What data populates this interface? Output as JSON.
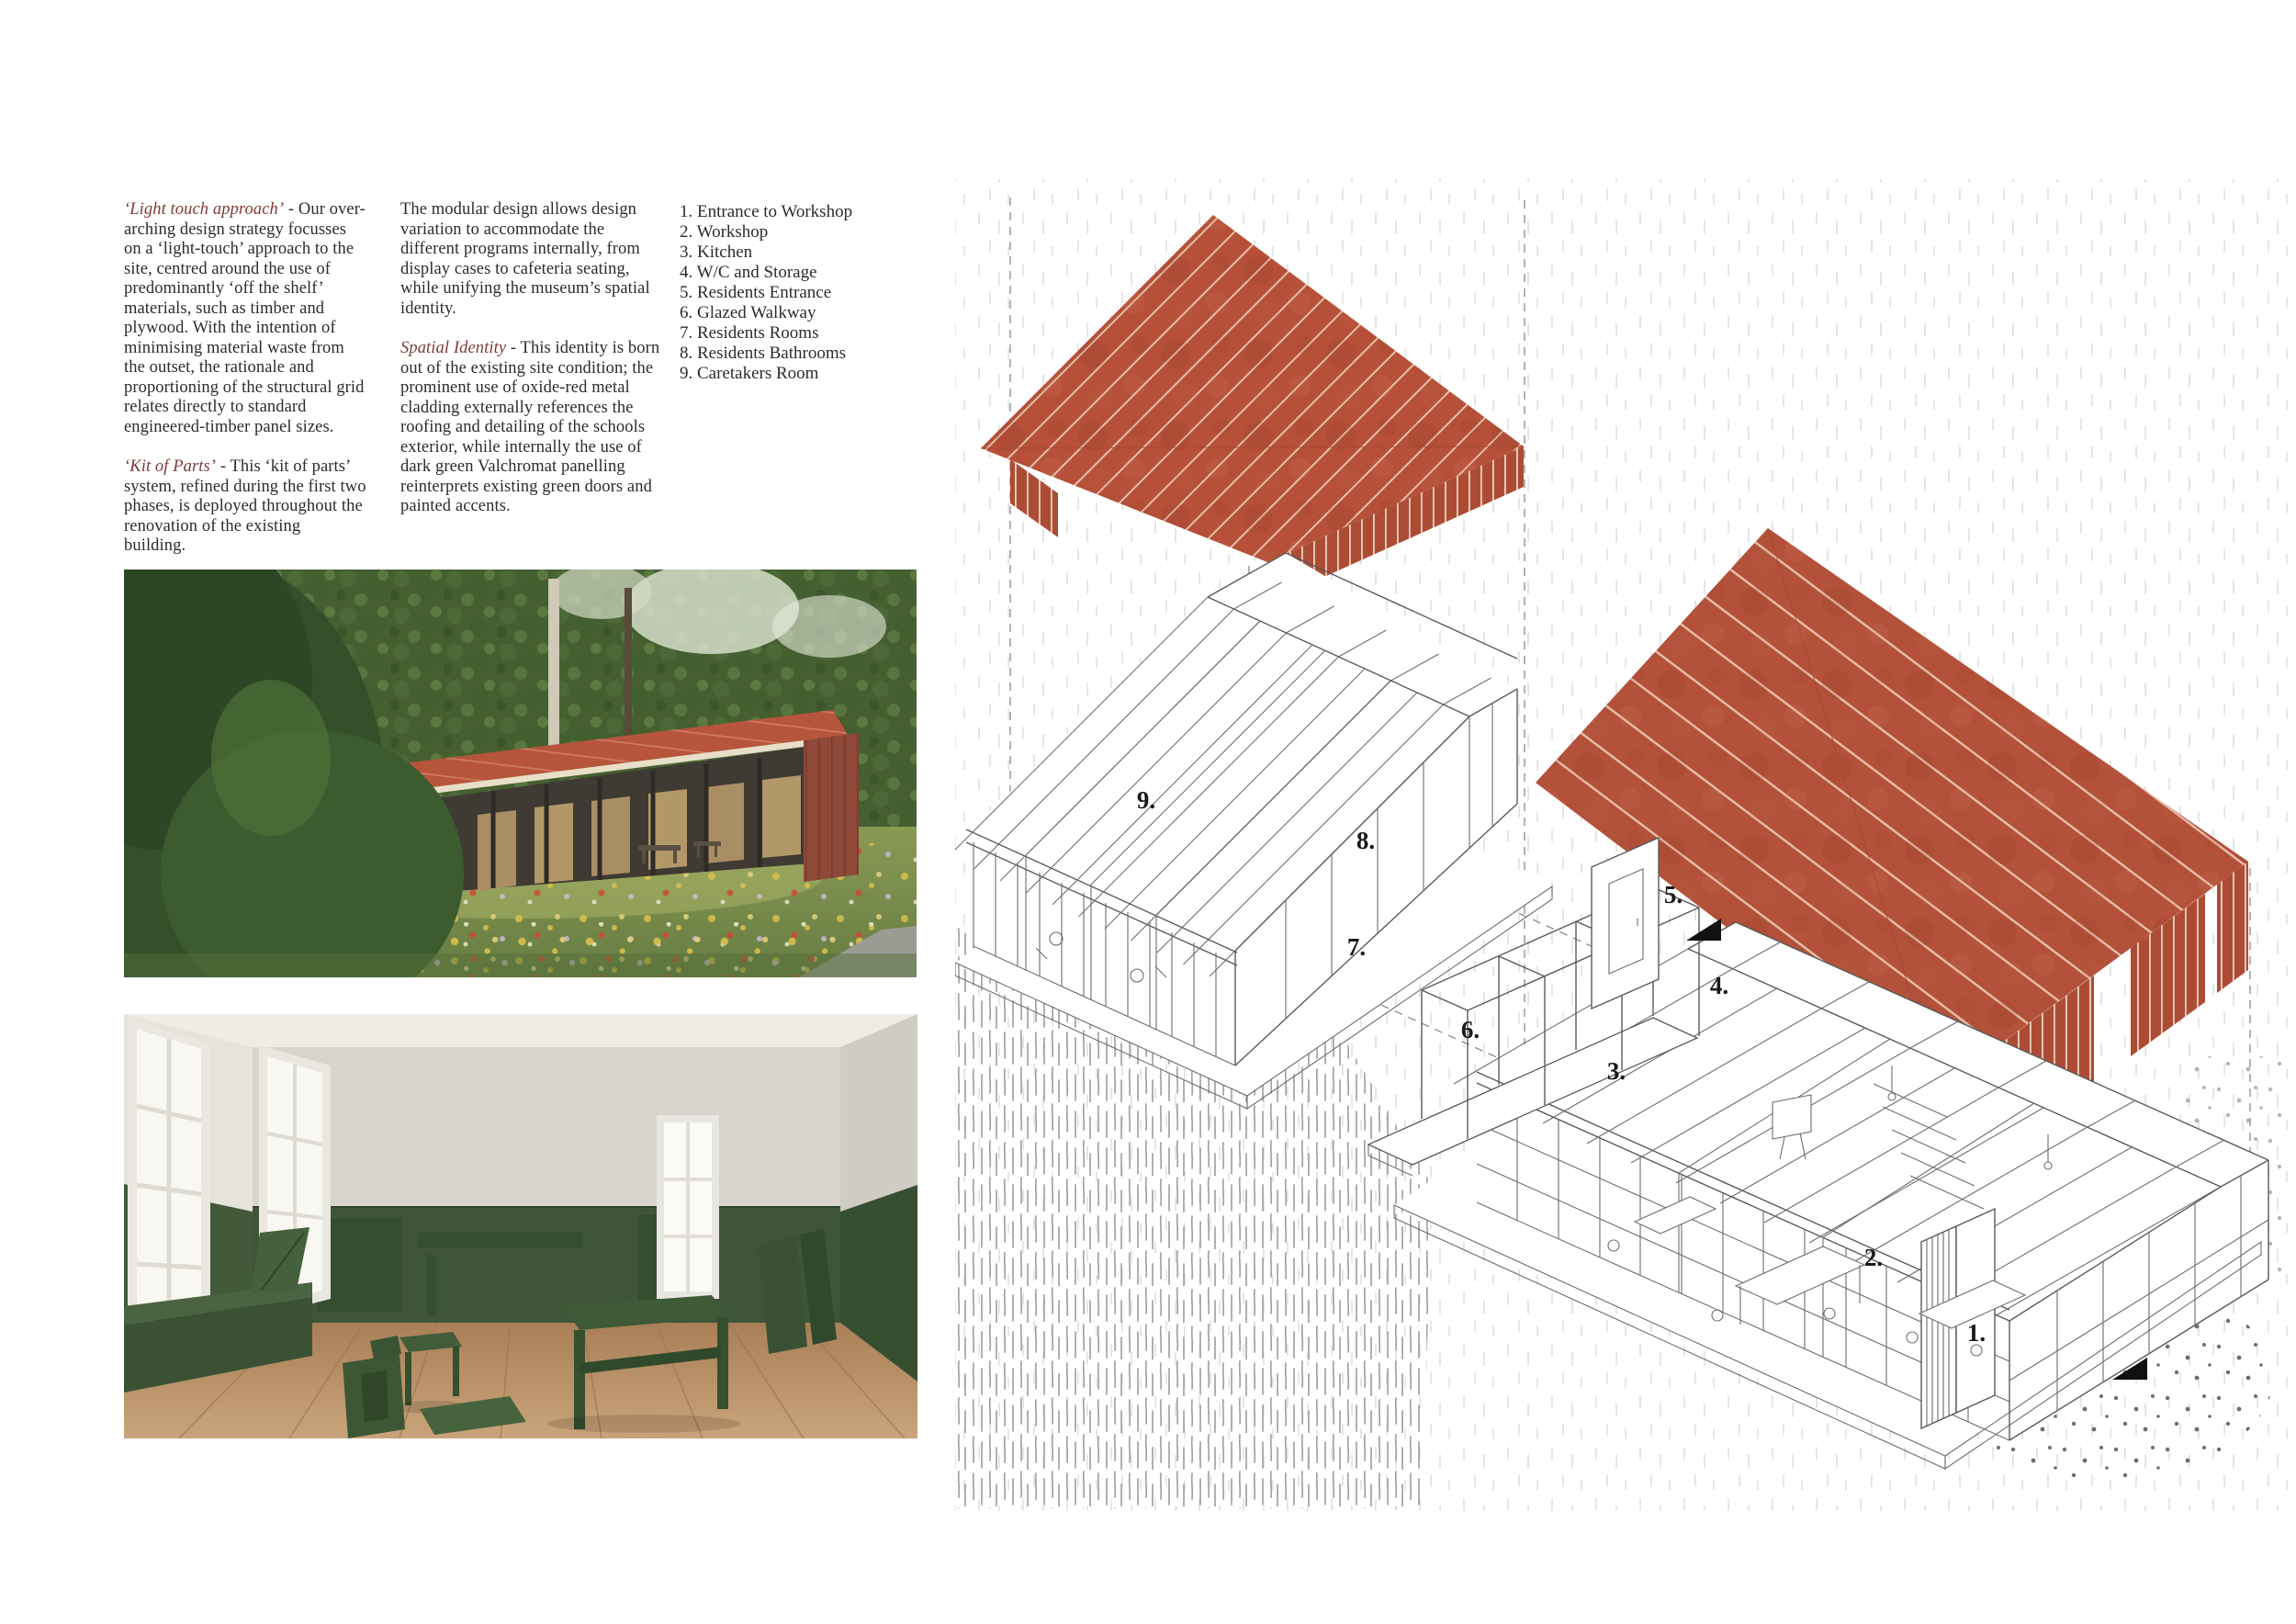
{
  "intro": {
    "col1": {
      "p1_lead": "‘Light touch approach’",
      "p1_body": "- Our over-arching design strategy focusses on a ‘light-touch’ approach to the site, centred around the use of predominantly ‘off the shelf’ materials, such as timber and plywood. With the intention of minimising material waste from the outset, the rationale and proportioning of the structural grid relates directly to standard engineered-timber panel sizes.",
      "p2_lead": "‘Kit of Parts’",
      "p2_body": "- This ‘kit of parts’ system, refined during the first two phases, is deployed throughout the renovation of the existing building."
    },
    "col2": {
      "p1_body": "The modular design allows design variation to accommodate the different programs internally, from display cases to cafeteria seating, while unifying the museum’s spatial identity.",
      "p2_lead": "Spatial Identity",
      "p2_body": "- This identity is born out of the existing site condition; the prominent use of oxide-red metal cladding externally references the roofing and detailing of the schools exterior, while internally the use of dark green Valchromat panelling reinterprets existing green doors and painted accents."
    }
  },
  "legend": {
    "items": [
      "1. Entrance to Workshop",
      "2. Workshop",
      "3. Kitchen",
      "4. W/C and Storage",
      "5. Residents Entrance",
      "6. Glazed Walkway",
      "7. Residents Rooms",
      "8. Residents Bathrooms",
      "9. Caretakers Room"
    ]
  },
  "figures": {
    "axon_a": {
      "labels": [
        "9.",
        "8.",
        "7."
      ]
    },
    "axon_b": {
      "labels": [
        "6.",
        "5.",
        "4.",
        "3.",
        "2.",
        "1."
      ]
    }
  },
  "colors": {
    "accent_text_red": "#7d3c36",
    "roof_oxide_red": "#b65038",
    "roof_seam": "#e6c0ab",
    "valchromat_green": "#3e5637",
    "drawing_line": "#5a5a5a",
    "wood_floor": "#b98f66"
  }
}
